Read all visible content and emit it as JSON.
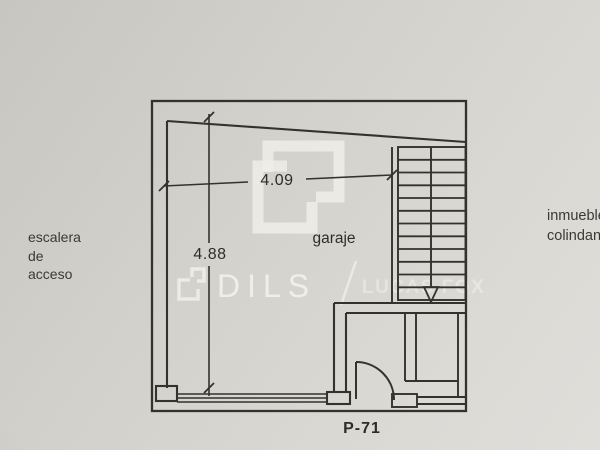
{
  "plan": {
    "type": "floor-plan",
    "room_label": "garaje",
    "plan_number": "P-71",
    "dimensions": {
      "width_label": "4.09",
      "height_label": "4.88"
    },
    "annotations": {
      "left": {
        "lines": [
          "escalera",
          "de",
          "acceso"
        ]
      },
      "right": {
        "lines": [
          "inmueble",
          "colindante"
        ]
      }
    },
    "stairs": {
      "treads": 12,
      "direction": "down"
    }
  },
  "watermark": {
    "brand_left": "DILS",
    "separator": "/",
    "brand_right": "LUCAS FOX",
    "logo": "dils-bracket-logo"
  },
  "colors": {
    "paper": "#d3d1cc",
    "ink": "#2f2e2b",
    "watermark": "#edece7"
  }
}
